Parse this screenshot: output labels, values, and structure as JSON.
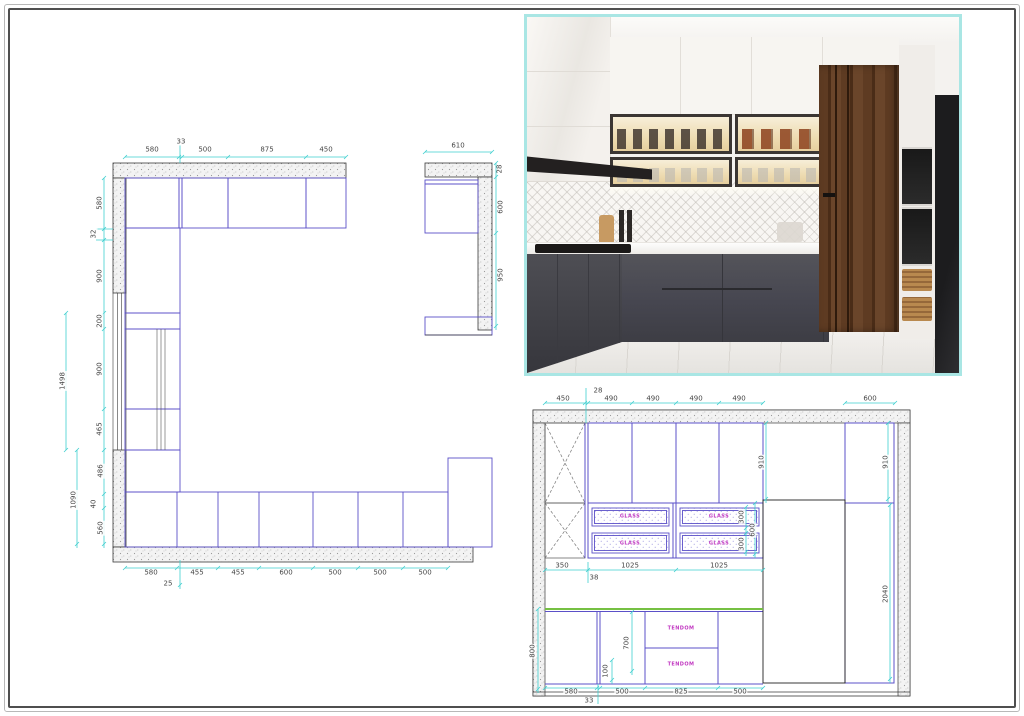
{
  "colors": {
    "dimension_cyan": "#3fcfcf",
    "cabinet_line_purple": "#5b50c8",
    "wall_line": "#3a3a3a",
    "annotation_magenta": "#c23ac2",
    "countertop_green": "#76c043",
    "photo_border_teal": "#a9e6e4",
    "base_cabinet_grey": "#46464c",
    "wood_panel_brown": "#5e3b22"
  },
  "plan": {
    "dims": [
      {
        "t": "580",
        "x": 152,
        "y": 150
      },
      {
        "t": "33",
        "x": 181,
        "y": 142
      },
      {
        "t": "500",
        "x": 205,
        "y": 150
      },
      {
        "t": "875",
        "x": 267,
        "y": 150
      },
      {
        "t": "450",
        "x": 326,
        "y": 150
      },
      {
        "t": "580",
        "x": 100,
        "y": 203,
        "r": 1
      },
      {
        "t": "32",
        "x": 94,
        "y": 234,
        "r": 1
      },
      {
        "t": "900",
        "x": 100,
        "y": 276,
        "r": 1
      },
      {
        "t": "200",
        "x": 100,
        "y": 321,
        "r": 1
      },
      {
        "t": "900",
        "x": 100,
        "y": 369,
        "r": 1
      },
      {
        "t": "465",
        "x": 100,
        "y": 429,
        "r": 1
      },
      {
        "t": "1498",
        "x": 63,
        "y": 381,
        "r": 1
      },
      {
        "t": "486",
        "x": 101,
        "y": 471,
        "r": 1
      },
      {
        "t": "40",
        "x": 94,
        "y": 504,
        "r": 1
      },
      {
        "t": "560",
        "x": 101,
        "y": 528,
        "r": 1
      },
      {
        "t": "1090",
        "x": 74,
        "y": 500,
        "r": 1
      },
      {
        "t": "580",
        "x": 151,
        "y": 573
      },
      {
        "t": "455",
        "x": 197,
        "y": 573
      },
      {
        "t": "455",
        "x": 238,
        "y": 573
      },
      {
        "t": "600",
        "x": 286,
        "y": 573
      },
      {
        "t": "500",
        "x": 335,
        "y": 573
      },
      {
        "t": "500",
        "x": 380,
        "y": 573
      },
      {
        "t": "500",
        "x": 425,
        "y": 573
      },
      {
        "t": "25",
        "x": 168,
        "y": 584
      }
    ]
  },
  "small_plan": {
    "dims": [
      {
        "t": "610",
        "x": 458,
        "y": 146
      },
      {
        "t": "28",
        "x": 500,
        "y": 169,
        "r": 1
      },
      {
        "t": "600",
        "x": 501,
        "y": 207,
        "r": 1
      },
      {
        "t": "950",
        "x": 501,
        "y": 275,
        "r": 1
      }
    ]
  },
  "elevation": {
    "dims": [
      {
        "t": "450",
        "x": 563,
        "y": 399
      },
      {
        "t": "28",
        "x": 598,
        "y": 391
      },
      {
        "t": "490",
        "x": 611,
        "y": 399
      },
      {
        "t": "490",
        "x": 653,
        "y": 399
      },
      {
        "t": "490",
        "x": 696,
        "y": 399
      },
      {
        "t": "490",
        "x": 739,
        "y": 399
      },
      {
        "t": "600",
        "x": 870,
        "y": 399
      },
      {
        "t": "910",
        "x": 762,
        "y": 462,
        "r": 1
      },
      {
        "t": "910",
        "x": 886,
        "y": 462,
        "r": 1
      },
      {
        "t": "300",
        "x": 742,
        "y": 517,
        "r": 1
      },
      {
        "t": "300",
        "x": 742,
        "y": 544,
        "r": 1
      },
      {
        "t": "600",
        "x": 753,
        "y": 530,
        "r": 1
      },
      {
        "t": "350",
        "x": 562,
        "y": 566
      },
      {
        "t": "1025",
        "x": 630,
        "y": 566
      },
      {
        "t": "1025",
        "x": 719,
        "y": 566
      },
      {
        "t": "38",
        "x": 594,
        "y": 578
      },
      {
        "t": "2040",
        "x": 886,
        "y": 594,
        "r": 1
      },
      {
        "t": "800",
        "x": 533,
        "y": 651,
        "r": 1
      },
      {
        "t": "700",
        "x": 627,
        "y": 643,
        "r": 1
      },
      {
        "t": "100",
        "x": 606,
        "y": 671,
        "r": 1
      },
      {
        "t": "580",
        "x": 571,
        "y": 692
      },
      {
        "t": "500",
        "x": 622,
        "y": 692
      },
      {
        "t": "825",
        "x": 681,
        "y": 692
      },
      {
        "t": "500",
        "x": 740,
        "y": 692
      },
      {
        "t": "33",
        "x": 589,
        "y": 701
      }
    ],
    "notes": [
      {
        "t": "GLASS",
        "x": 630,
        "y": 517
      },
      {
        "t": "GLASS",
        "x": 719,
        "y": 517
      },
      {
        "t": "GLASS",
        "x": 630,
        "y": 544
      },
      {
        "t": "GLASS",
        "x": 719,
        "y": 544
      },
      {
        "t": "TENDOM",
        "x": 681,
        "y": 629
      },
      {
        "t": "TENDOM",
        "x": 681,
        "y": 665
      }
    ]
  }
}
